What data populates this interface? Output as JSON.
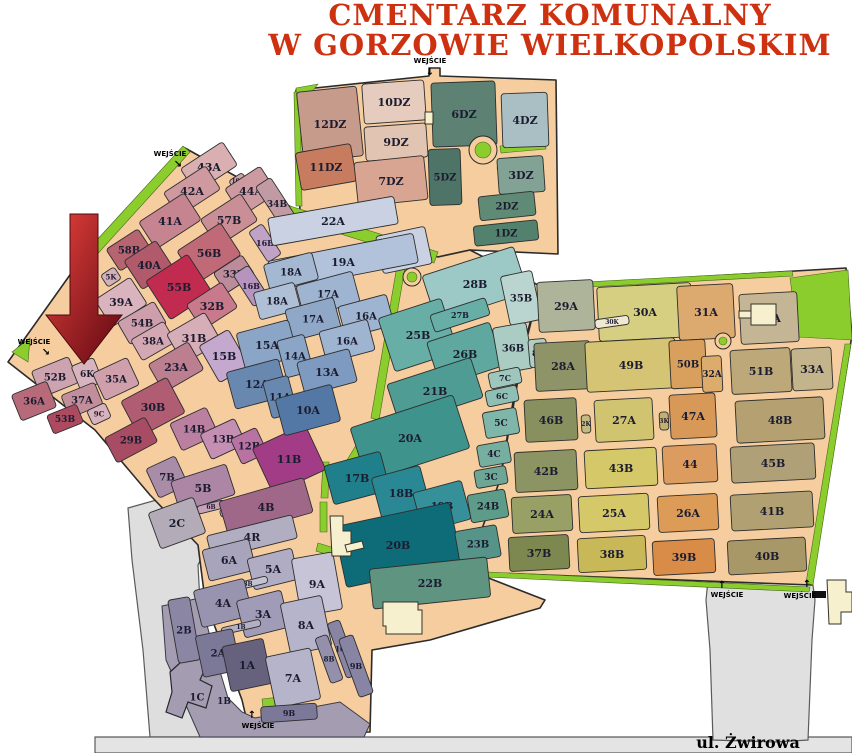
{
  "title": {
    "line1": "CMENTARZ KOMUNALNY",
    "line2": "W GORZOWIE WIELKOPOLSKIM",
    "color": "#CE3110"
  },
  "street_label": "ul. Żwirowa",
  "entrance_label": "WEJŚCIE",
  "palette": {
    "path": "#F5CD9E",
    "outline": "#2B2B2B",
    "green": "#8CCD2E",
    "green_edge": "#47681A",
    "road_grey": "#DEDEDE",
    "road_stroke": "#5A5A5A",
    "purple_grey": "#A49CB0",
    "label": "#1C1C30",
    "building": "#F7F0CE"
  },
  "base": [
    {
      "name": "dz-zone",
      "points": "296,90 429,76 429,68 440,68 440,76 556,80 558,254 470,250 438,257 300,212"
    },
    {
      "name": "central-zone",
      "points": "185,148 300,212 438,257 470,250 540,286 520,360 500,480 468,570 545,600 540,608 430,640 372,650 370,732 250,734 242,700 205,600 198,545 150,495 95,430 8,362 82,258"
    },
    {
      "name": "east-zone",
      "points": "540,286 846,268 852,335 812,585 466,572 500,480 522,358"
    }
  ],
  "roads": [
    {
      "name": "southwest-road",
      "points": "128,508 206,486 230,510 212,535 198,565 202,640 225,700 243,737 150,737 143,650 132,560",
      "fill": "#DEDEDE"
    },
    {
      "name": "south-road",
      "points": "95,737 852,737 852,753 95,753",
      "fill": "#E4E4E4"
    },
    {
      "name": "southeast-parking",
      "points": "708,580 812,578 815,600 812,640 808,740 775,742 713,740 710,650 706,600",
      "fill": "#E0E0E0"
    }
  ],
  "purple_grey_zone": {
    "name": "south-block-apron",
    "points": "162,606 200,598 213,648 228,698 242,712 255,718 340,702 370,724 364,737 200,737 166,660"
  },
  "building_1c": {
    "points": "170,672 192,652 208,662 200,680 212,686 206,708 188,702 182,718 166,712 172,692"
  },
  "greens": [
    "290,206 438,252 434,263 286,217",
    "183,146 190,152 92,260 84,254",
    "294,92 300,92 302,206 296,206",
    "500,146 545,142 546,149 501,153",
    "497,168 505,172 522,205 514,210",
    "399,254 407,256 379,420 371,418",
    "369,424 377,426 352,468 344,465",
    "320,502 327,502 327,532 320,532",
    "318,543 334,548 332,556 316,551",
    "323,462 329,462 328,498 321,498",
    "790,278 848,270 852,340 798,337",
    "845,344 851,344 813,585 806,583",
    "466,571 810,587 809,592 465,576",
    "548,284 792,271 793,276 549,289",
    "262,699 280,697 282,714 264,716",
    "12,352 30,338 28,362",
    "58,330 72,318 70,340",
    "296,88 318,84 298,110"
  ],
  "buildings": [
    {
      "points": "330,516 343,516 343,531 351,531 351,556 332,556"
    },
    {
      "points": "345,545 362,541 364,548 347,552"
    },
    {
      "points": "383,602 418,602 418,610 422,610 422,634 386,634 386,626 383,626"
    },
    {
      "points": "827,580 846,580 846,592 852,592 852,612 841,612 841,624 829,624"
    },
    {
      "points": "751,304 776,304 776,325 751,325"
    },
    {
      "points": "739,311 751,311 751,318 739,318"
    },
    {
      "points": "425,112 433,112 433,124 425,124"
    }
  ],
  "black_marks": [
    [
      812,
      591,
      14,
      7
    ]
  ],
  "roundabouts": [
    [
      483,
      150,
      14,
      8
    ],
    [
      412,
      277,
      9,
      5
    ],
    [
      723,
      341,
      8,
      4
    ]
  ],
  "arrow": {
    "points": "70,214 98,214 98,315 122,315 84,364 46,315 70,315",
    "from": "#E8423C",
    "to": "#5E0812"
  },
  "entrances": [
    {
      "x": 170,
      "y": 156,
      "ax": 178,
      "ay": 167,
      "glyph": "↘"
    },
    {
      "x": 430,
      "y": 63,
      "ax": 430,
      "ay": 75,
      "glyph": "↓"
    },
    {
      "x": 34,
      "y": 344,
      "ax": 46,
      "ay": 355,
      "glyph": "↘"
    },
    {
      "x": 727,
      "y": 597,
      "ax": 722,
      "ay": 588,
      "glyph": "↑"
    },
    {
      "x": 800,
      "y": 598,
      "ax": 807,
      "ay": 587,
      "glyph": "↑"
    },
    {
      "x": 258,
      "y": 728,
      "ax": 252,
      "ay": 718,
      "glyph": "↑"
    }
  ],
  "street_label_pos": {
    "x": 748,
    "y": 748
  },
  "sections": [
    [
      "12DZ",
      330,
      124,
      60,
      70,
      -6,
      "#C69B8B",
      11
    ],
    [
      "10DZ",
      394,
      102,
      62,
      40,
      -4,
      "#E6CCBE",
      11
    ],
    [
      "9DZ",
      396,
      142,
      62,
      34,
      -4,
      "#E2C4B2",
      11
    ],
    [
      "6DZ",
      464,
      114,
      64,
      64,
      -2,
      "#5D8173",
      11
    ],
    [
      "4DZ",
      525,
      120,
      46,
      54,
      -2,
      "#A9BFC3",
      11
    ],
    [
      "11DZ",
      326,
      167,
      56,
      38,
      -10,
      "#C87C5F",
      11
    ],
    [
      "7DZ",
      391,
      181,
      70,
      44,
      -6,
      "#D8A593",
      11
    ],
    [
      "5DZ",
      445,
      177,
      32,
      56,
      -2,
      "#4E7467",
      10
    ],
    [
      "3DZ",
      521,
      175,
      46,
      36,
      -4,
      "#81A294",
      11
    ],
    [
      "2DZ",
      507,
      206,
      56,
      24,
      -6,
      "#5F8A76",
      10
    ],
    [
      "1DZ",
      506,
      233,
      64,
      20,
      -6,
      "#52826E",
      10
    ],
    [
      "43A",
      209,
      167,
      50,
      28,
      -33,
      "#D9AFB2",
      11
    ],
    [
      "42A",
      192,
      191,
      50,
      28,
      -33,
      "#CE9AA0",
      11
    ],
    [
      "10C",
      238,
      181,
      16,
      10,
      -33,
      "#D2A4A8",
      6
    ],
    [
      "44A",
      251,
      191,
      42,
      32,
      -33,
      "#CC9AA0",
      11
    ],
    [
      "34B",
      277,
      204,
      18,
      52,
      -33,
      "#C29AA4",
      9
    ],
    [
      "41A",
      170,
      221,
      54,
      32,
      -33,
      "#C58490",
      11
    ],
    [
      "57B",
      229,
      220,
      48,
      32,
      -33,
      "#CA8F96",
      11
    ],
    [
      "58B",
      129,
      250,
      38,
      26,
      -33,
      "#B56470",
      10
    ],
    [
      "40A",
      149,
      265,
      38,
      34,
      -33,
      "#B05A6C",
      11
    ],
    [
      "56B",
      209,
      253,
      52,
      38,
      -33,
      "#C06A78",
      11
    ],
    [
      "33B",
      234,
      274,
      34,
      24,
      -33,
      "#BD8C9A",
      10
    ],
    [
      "16B",
      265,
      243,
      16,
      36,
      -33,
      "#C0A2C6",
      8
    ],
    [
      "16B",
      251,
      286,
      18,
      38,
      -33,
      "#B794BE",
      8
    ],
    [
      "5K",
      111,
      277,
      16,
      14,
      -33,
      "#D3AFB9",
      7
    ],
    [
      "39A",
      121,
      302,
      42,
      32,
      -33,
      "#D9B4BE",
      11
    ],
    [
      "55B",
      179,
      287,
      50,
      46,
      -33,
      "#C22B50",
      11
    ],
    [
      "32B",
      212,
      306,
      42,
      30,
      -33,
      "#C87A8C",
      11
    ],
    [
      "54B",
      142,
      323,
      42,
      26,
      -30,
      "#CD9FAC",
      10
    ],
    [
      "38A",
      153,
      341,
      38,
      24,
      -30,
      "#D3A8B2",
      10
    ],
    [
      "31B",
      194,
      338,
      44,
      34,
      -30,
      "#D6AEB8",
      11
    ],
    [
      "23A",
      176,
      367,
      46,
      32,
      -30,
      "#BB7F90",
      11
    ],
    [
      "15B",
      224,
      356,
      34,
      42,
      -30,
      "#C5A8CE",
      11
    ],
    [
      "52B",
      55,
      377,
      40,
      28,
      -22,
      "#CCA3AF",
      10
    ],
    [
      "6K",
      87,
      374,
      24,
      26,
      -22,
      "#D8B5BE",
      9
    ],
    [
      "35A",
      116,
      379,
      38,
      30,
      -25,
      "#CF9FAB",
      10
    ],
    [
      "36A",
      34,
      401,
      38,
      28,
      -22,
      "#B66A7A",
      10
    ],
    [
      "37A",
      82,
      400,
      36,
      24,
      -22,
      "#C28E9C",
      10
    ],
    [
      "9C",
      99,
      414,
      20,
      16,
      -25,
      "#D8B2BC",
      7
    ],
    [
      "53B",
      65,
      419,
      32,
      20,
      -22,
      "#AC4A60",
      9
    ],
    [
      "30B",
      153,
      407,
      52,
      40,
      -28,
      "#B05C72",
      11
    ],
    [
      "29B",
      131,
      440,
      46,
      28,
      -28,
      "#A84C64",
      10
    ],
    [
      "14B",
      194,
      429,
      40,
      30,
      -25,
      "#BB7FA0",
      10
    ],
    [
      "13B",
      223,
      439,
      38,
      28,
      -25,
      "#C48FB2",
      10
    ],
    [
      "12B",
      249,
      446,
      28,
      28,
      -25,
      "#B873A2",
      10
    ],
    [
      "11B",
      289,
      459,
      58,
      50,
      -25,
      "#A23C86",
      11
    ],
    [
      "22A",
      333,
      221,
      128,
      28,
      -10,
      "#C9D1E3",
      11
    ],
    [
      "21A",
      404,
      250,
      50,
      38,
      -12,
      "#C9D1E3",
      11
    ],
    [
      "19A",
      343,
      262,
      148,
      30,
      -11,
      "#B2C2DA",
      11
    ],
    [
      "18A",
      291,
      272,
      50,
      28,
      -15,
      "#A4B8D2",
      10
    ],
    [
      "17A",
      328,
      294,
      58,
      32,
      -15,
      "#9FB4D0",
      10
    ],
    [
      "16A",
      366,
      316,
      50,
      32,
      -15,
      "#9FB4D0",
      10
    ],
    [
      "18A",
      277,
      301,
      42,
      28,
      -15,
      "#AEBFD6",
      10
    ],
    [
      "17A",
      313,
      319,
      50,
      32,
      -15,
      "#8FA8C8",
      10
    ],
    [
      "16A",
      347,
      341,
      50,
      32,
      -15,
      "#9FB4D0",
      10
    ],
    [
      "15A",
      267,
      345,
      54,
      38,
      -15,
      "#8BA5C6",
      11
    ],
    [
      "14A",
      295,
      356,
      28,
      38,
      -15,
      "#8BA5C6",
      10
    ],
    [
      "13A",
      327,
      372,
      54,
      34,
      -15,
      "#7E9AC0",
      11
    ],
    [
      "12A",
      257,
      384,
      54,
      38,
      -15,
      "#6888B0",
      11
    ],
    [
      "11A",
      280,
      397,
      26,
      38,
      -15,
      "#6888B0",
      10
    ],
    [
      "10A",
      308,
      410,
      58,
      38,
      -15,
      "#5478A6",
      11
    ],
    [
      "28B",
      475,
      284,
      96,
      48,
      -18,
      "#9CC8C6",
      11
    ],
    [
      "35B",
      521,
      298,
      32,
      50,
      -12,
      "#BAD5CF",
      10
    ],
    [
      "25B",
      418,
      335,
      66,
      56,
      -18,
      "#66AEA6",
      11
    ],
    [
      "27B",
      460,
      315,
      58,
      18,
      -18,
      "#66AEA6",
      8
    ],
    [
      "26B",
      465,
      354,
      66,
      46,
      -18,
      "#5FA8A0",
      11
    ],
    [
      "36B",
      513,
      348,
      34,
      46,
      -10,
      "#AACCC2",
      10
    ],
    [
      "8C",
      538,
      353,
      18,
      28,
      -5,
      "#B2CEC2",
      8
    ],
    [
      "7C",
      505,
      378,
      32,
      16,
      -12,
      "#9EC6BC",
      8
    ],
    [
      "6C",
      502,
      396,
      32,
      16,
      -12,
      "#8EBEB4",
      8
    ],
    [
      "5C",
      501,
      423,
      34,
      26,
      -10,
      "#7EB6AA",
      9
    ],
    [
      "4C",
      494,
      454,
      32,
      22,
      -10,
      "#76AEA0",
      9
    ],
    [
      "3C",
      491,
      477,
      32,
      18,
      -10,
      "#6EA696",
      9
    ],
    [
      "21B",
      435,
      391,
      88,
      42,
      -18,
      "#4E9C94",
      11
    ],
    [
      "20A",
      410,
      438,
      108,
      56,
      -18,
      "#3E948C",
      11
    ],
    [
      "17B",
      357,
      478,
      58,
      40,
      -15,
      "#1F808C",
      11
    ],
    [
      "18B",
      401,
      493,
      50,
      44,
      -15,
      "#2A8894",
      11
    ],
    [
      "19B",
      442,
      506,
      50,
      40,
      -15,
      "#35909A",
      10
    ],
    [
      "20B",
      398,
      545,
      118,
      62,
      -12,
      "#0E6C78",
      11
    ],
    [
      "24B",
      488,
      506,
      38,
      28,
      -10,
      "#5E9C8A",
      10
    ],
    [
      "23B",
      478,
      544,
      42,
      32,
      -10,
      "#56948A",
      10
    ],
    [
      "22B",
      430,
      583,
      118,
      40,
      -6,
      "#5E9480",
      11
    ],
    [
      "29A",
      566,
      306,
      56,
      50,
      -3,
      "#AEB49A",
      11
    ],
    [
      "30A",
      645,
      312,
      94,
      54,
      -3,
      "#D6CE80",
      11
    ],
    [
      "30K",
      612,
      322,
      34,
      9,
      -8,
      "#EFE8D2",
      6
    ],
    [
      "31A",
      706,
      312,
      56,
      54,
      -3,
      "#DCA96E",
      11
    ],
    [
      "34A",
      769,
      318,
      58,
      50,
      -3,
      "#C4B694",
      11
    ],
    [
      "28A",
      563,
      366,
      56,
      48,
      -3,
      "#8E9468",
      11
    ],
    [
      "49B",
      631,
      365,
      90,
      50,
      -3,
      "#D4C474",
      11
    ],
    [
      "50B",
      688,
      364,
      36,
      48,
      -3,
      "#D8A05C",
      10
    ],
    [
      "32A",
      712,
      374,
      20,
      36,
      -3,
      "#DCAC6C",
      9
    ],
    [
      "51B",
      761,
      371,
      60,
      44,
      -3,
      "#BCA878",
      11
    ],
    [
      "33A",
      812,
      369,
      40,
      42,
      -3,
      "#C4B48C",
      11
    ],
    [
      "46B",
      551,
      420,
      52,
      42,
      -3,
      "#889060",
      11
    ],
    [
      "2K",
      586,
      424,
      9,
      18,
      -3,
      "#C2BA80",
      6
    ],
    [
      "27A",
      624,
      420,
      58,
      42,
      -3,
      "#D0C470",
      11
    ],
    [
      "3K",
      664,
      421,
      9,
      18,
      -3,
      "#C2B070",
      6
    ],
    [
      "47A",
      693,
      416,
      46,
      44,
      -3,
      "#D89858",
      11
    ],
    [
      "48B",
      780,
      420,
      88,
      42,
      -3,
      "#B4A070",
      11
    ],
    [
      "42B",
      546,
      471,
      62,
      40,
      -3,
      "#8C9464",
      11
    ],
    [
      "43B",
      621,
      468,
      72,
      38,
      -3,
      "#D4C868",
      11
    ],
    [
      "44",
      690,
      464,
      54,
      38,
      -3,
      "#DC9C60",
      11
    ],
    [
      "45B",
      773,
      463,
      84,
      36,
      -3,
      "#B0A078",
      11
    ],
    [
      "24A",
      542,
      514,
      60,
      36,
      -3,
      "#98A065",
      11
    ],
    [
      "25A",
      614,
      513,
      70,
      36,
      -3,
      "#D4C868",
      11
    ],
    [
      "26A",
      688,
      513,
      60,
      36,
      -3,
      "#DC9C58",
      11
    ],
    [
      "41B",
      772,
      511,
      82,
      36,
      -3,
      "#B0A072",
      11
    ],
    [
      "37B",
      539,
      553,
      60,
      34,
      -3,
      "#7C8850",
      11
    ],
    [
      "38B",
      612,
      554,
      68,
      34,
      -3,
      "#C8B858",
      11
    ],
    [
      "39B",
      684,
      557,
      62,
      34,
      -3,
      "#D88C48",
      11
    ],
    [
      "40B",
      767,
      556,
      78,
      34,
      -3,
      "#A89868",
      11
    ],
    [
      "7B",
      167,
      477,
      32,
      32,
      -25,
      "#A88CA8",
      10
    ],
    [
      "5B",
      203,
      488,
      58,
      32,
      -18,
      "#AD85A5",
      11
    ],
    [
      "6B",
      211,
      507,
      28,
      8,
      -14,
      "#C4A2B8",
      6
    ],
    [
      "4K",
      231,
      511,
      22,
      8,
      -14,
      "#C4A2B8",
      6
    ],
    [
      "4B",
      266,
      507,
      88,
      36,
      -16,
      "#A06888",
      11
    ],
    [
      "2C",
      177,
      523,
      48,
      38,
      -20,
      "#B3ABB7",
      11
    ],
    [
      "4R",
      252,
      537,
      88,
      24,
      -14,
      "#B2AEC2",
      11
    ],
    [
      "6A",
      229,
      560,
      48,
      32,
      -14,
      "#A8A4BC",
      11
    ],
    [
      "5A",
      273,
      569,
      46,
      32,
      -14,
      "#B0ACC4",
      11
    ],
    [
      "9A",
      317,
      584,
      42,
      58,
      -10,
      "#C6C4D6",
      11
    ],
    [
      "3B",
      248,
      584,
      40,
      7,
      -14,
      "#C4C2D2",
      6
    ],
    [
      "4A",
      223,
      603,
      52,
      38,
      -14,
      "#9894B0",
      11
    ],
    [
      "3A",
      263,
      614,
      46,
      38,
      -14,
      "#A09CB8",
      11
    ],
    [
      "8A",
      306,
      625,
      42,
      52,
      -12,
      "#B6B4CA",
      11
    ],
    [
      "1B",
      241,
      627,
      40,
      7,
      -13,
      "#B4B0C4",
      6
    ],
    [
      "2B",
      184,
      630,
      22,
      64,
      -10,
      "#8A86A4",
      10
    ],
    [
      "2A",
      218,
      653,
      38,
      42,
      -12,
      "#7C7898",
      10
    ],
    [
      "1A",
      247,
      665,
      42,
      46,
      -12,
      "#66627E",
      11
    ],
    [
      "10B",
      343,
      649,
      13,
      58,
      -20,
      "#8884A4",
      7
    ],
    [
      "8B",
      329,
      659,
      13,
      48,
      -20,
      "#9490AC",
      7
    ],
    [
      "9B",
      356,
      666,
      15,
      62,
      -20,
      "#8884A4",
      8
    ],
    [
      "7A",
      293,
      678,
      46,
      52,
      -12,
      "#B6B4CA",
      11
    ],
    [
      "9B",
      289,
      713,
      56,
      16,
      -4,
      "#7C7898",
      8
    ],
    [
      "1C",
      197,
      697,
      0,
      0,
      0,
      "none",
      10
    ],
    [
      "1B",
      224,
      701,
      0,
      0,
      0,
      "none",
      9
    ]
  ]
}
